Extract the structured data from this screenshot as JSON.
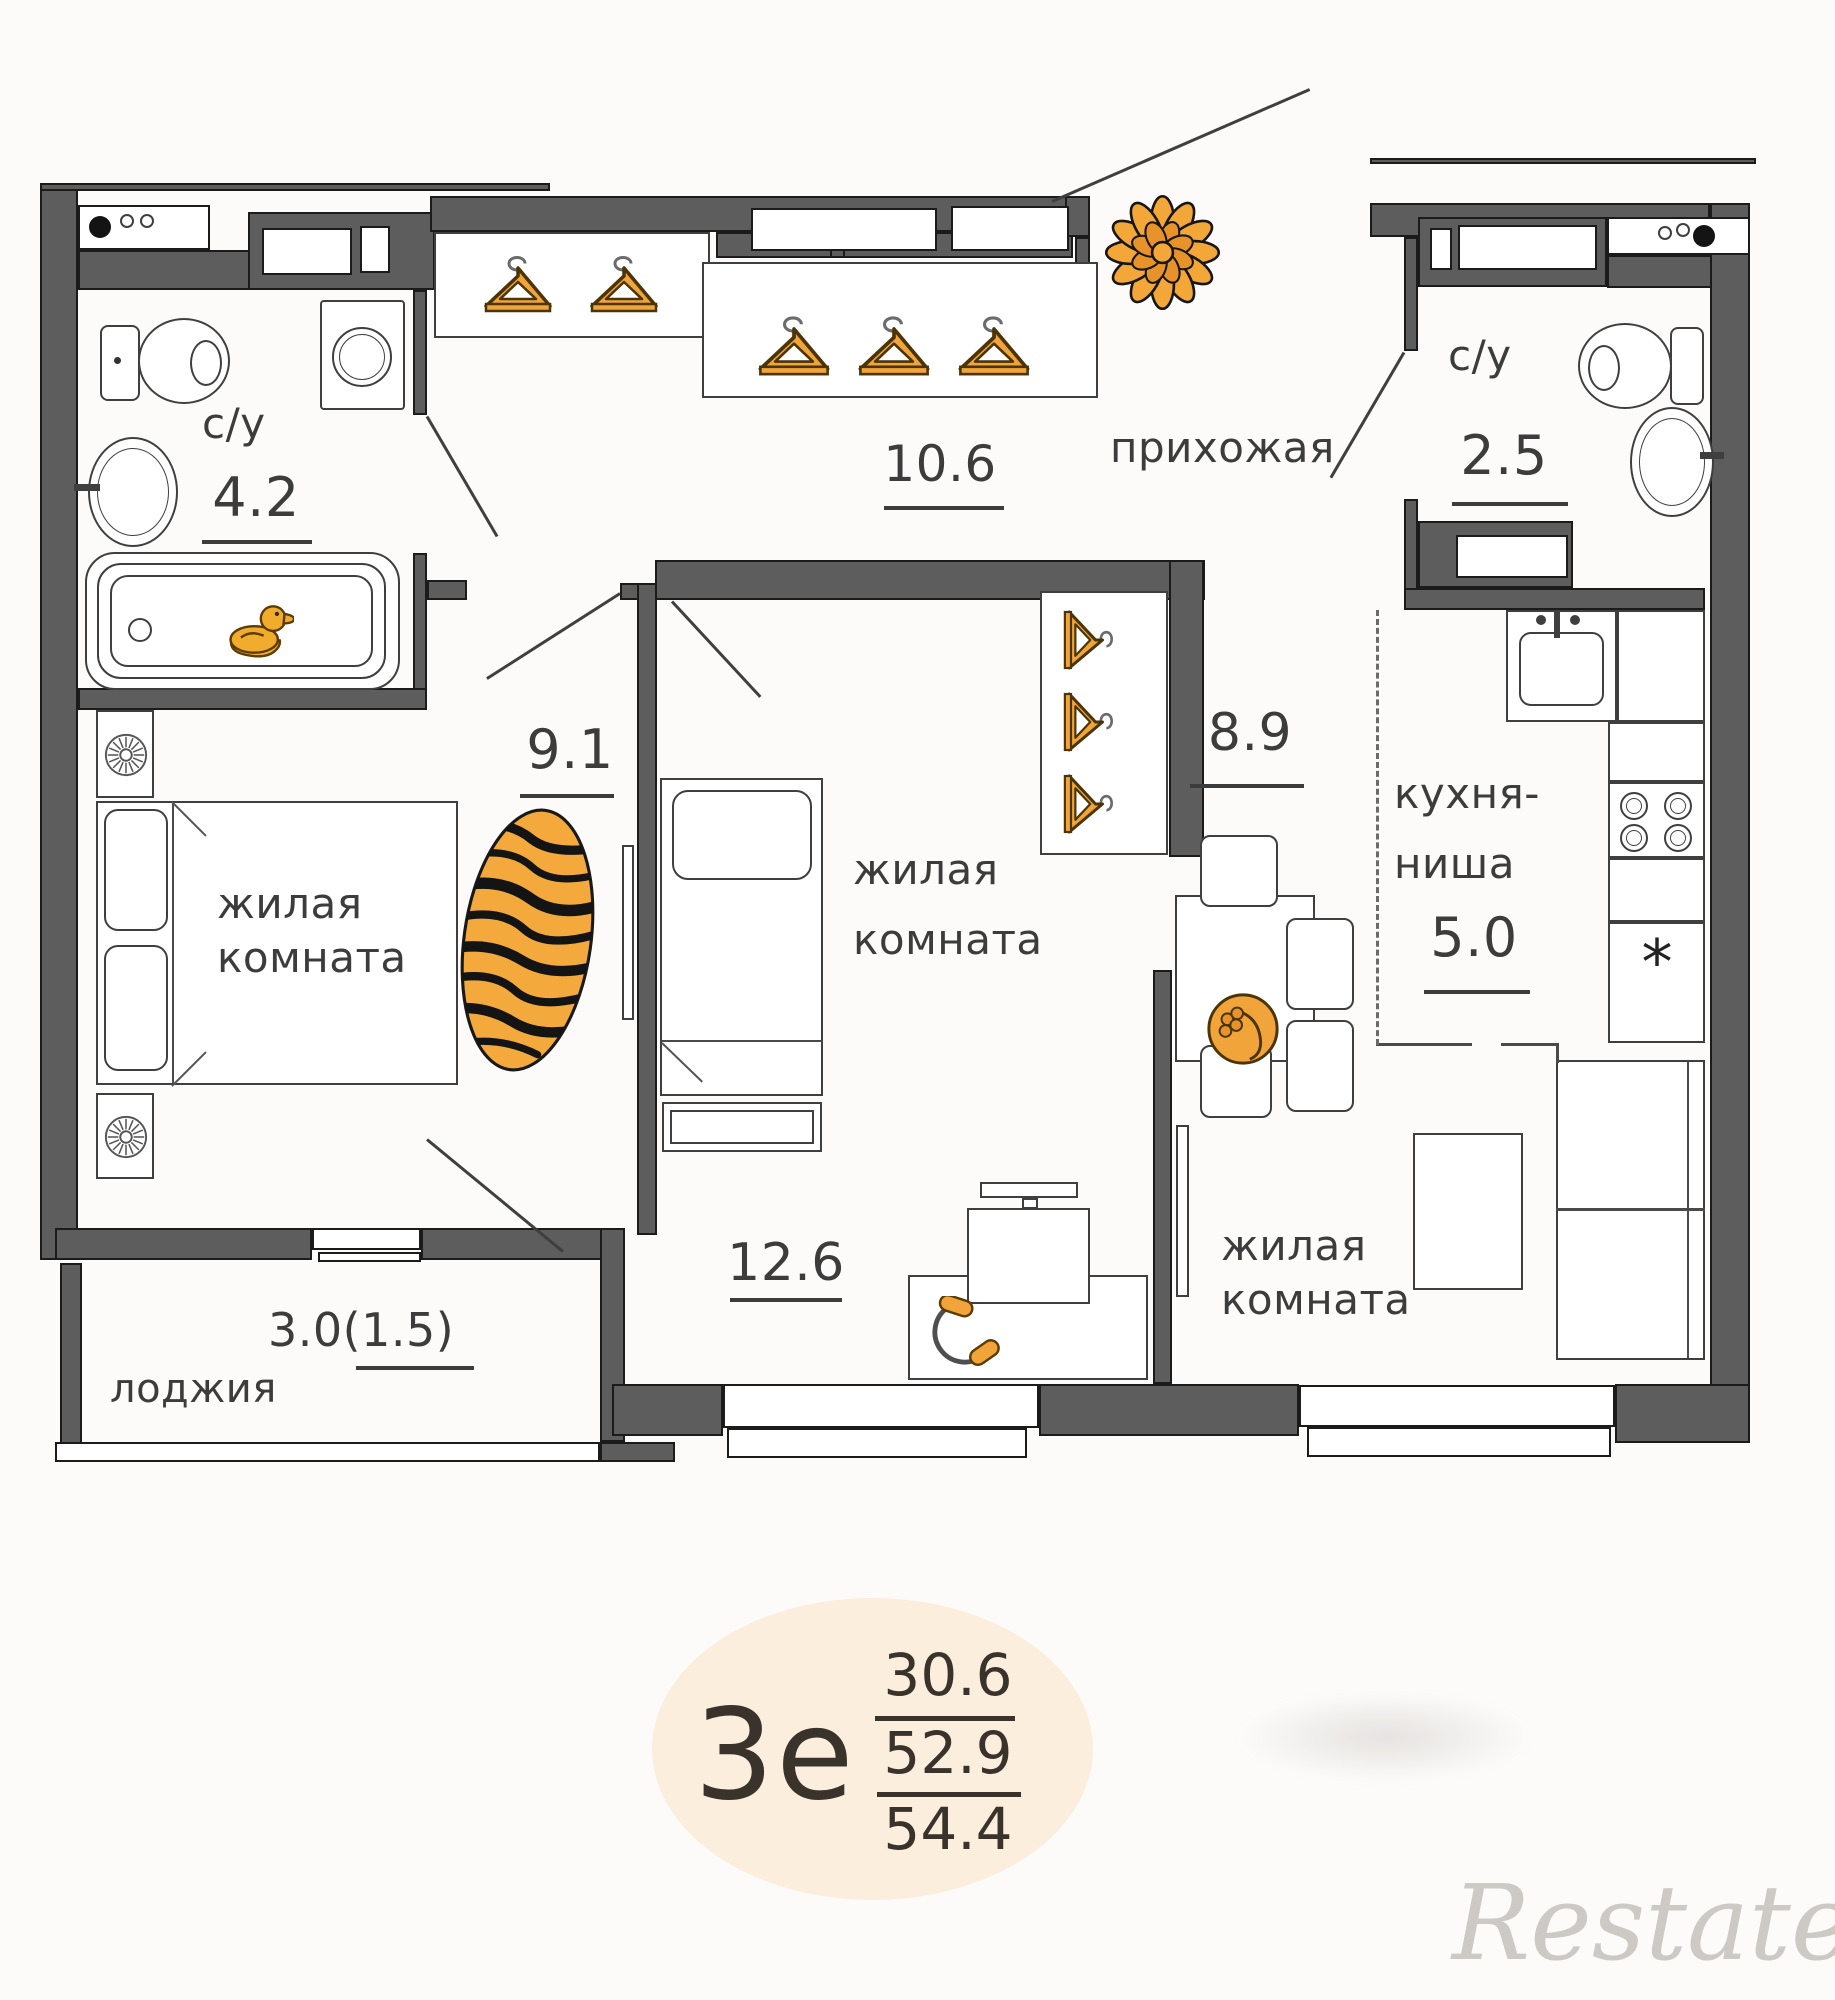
{
  "badge": {
    "type_label": "3е",
    "area_living": "30.6",
    "area_usable": "52.9",
    "area_total": "54.4"
  },
  "watermark": "Restate",
  "symbols": {
    "fridge_asterisk": "*"
  },
  "rooms": {
    "bathroom_main": {
      "label": "с/у",
      "area": "4.2"
    },
    "hallway": {
      "label": "прихожая",
      "area": "10.6"
    },
    "bathroom_guest": {
      "label": "с/у",
      "area": "2.5"
    },
    "bedroom": {
      "label_line1": "жилая",
      "label_line2": "комната",
      "area": "9.1"
    },
    "room_middle": {
      "label_line1": "жилая",
      "label_line2": "комната",
      "area": "12.6"
    },
    "room_right": {
      "label_line1": "жилая",
      "label_line2": "комната",
      "area": "8.9"
    },
    "kitchen_niche": {
      "label_line1": "кухня-",
      "label_line2": "ниша",
      "area": "5.0"
    },
    "loggia": {
      "label": "лоджия",
      "area": "3.0(1.5)"
    }
  },
  "colors": {
    "wall_fill": "#5d5d5d",
    "wall_outline": "#1b1b1b",
    "accent_orange": "#f0a43a",
    "badge_bg": "#fbeedd",
    "label_text": "#3c3c3c"
  }
}
